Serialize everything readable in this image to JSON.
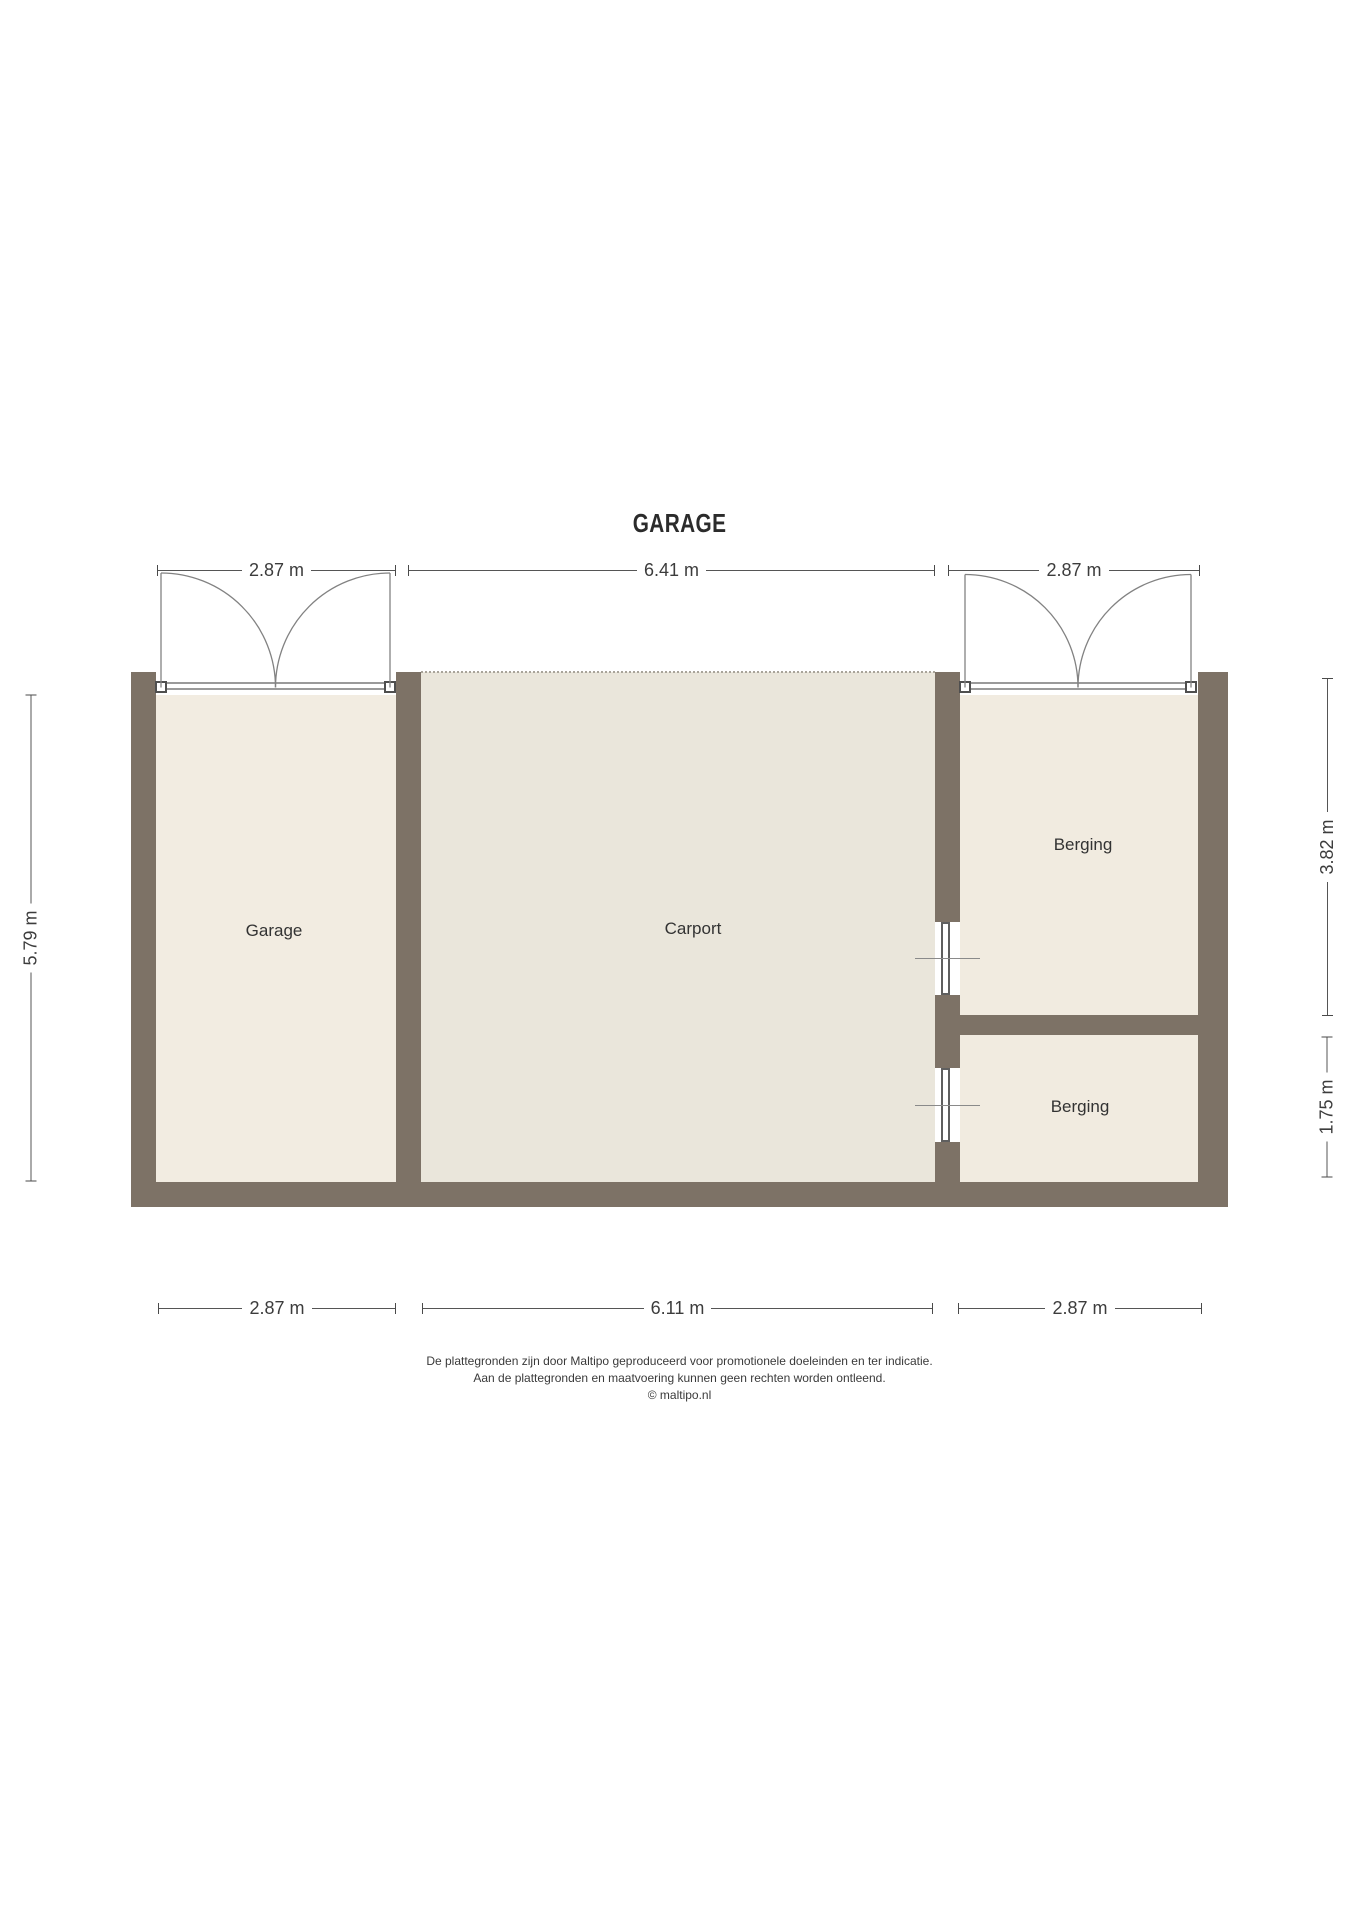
{
  "title": "GARAGE",
  "rooms": {
    "garage": "Garage",
    "carport": "Carport",
    "berging_top": "Berging",
    "berging_bottom": "Berging"
  },
  "dims": {
    "top_left": "2.87 m",
    "top_middle": "6.41 m",
    "top_right": "2.87 m",
    "left": "5.79 m",
    "right_upper": "3.82 m",
    "right_lower": "1.75 m",
    "bottom_left": "2.87 m",
    "bottom_middle": "6.11 m",
    "bottom_right": "2.87 m"
  },
  "footer": {
    "line1": "De plattegronden zijn door Maltipo geproduceerd voor promotionele doeleinden en ter indicatie.",
    "line2": "Aan de plattegronden en maatvoering kunnen geen rechten worden ontleend.",
    "line3": "© maltipo.nl"
  },
  "colors": {
    "wall": "#7D7266",
    "garage_floor": "#F2ECE1",
    "carport_floor": "#EAE6DB",
    "berging_floor": "#F1EBE0",
    "line": "#4a4a4a",
    "text": "#333333"
  }
}
